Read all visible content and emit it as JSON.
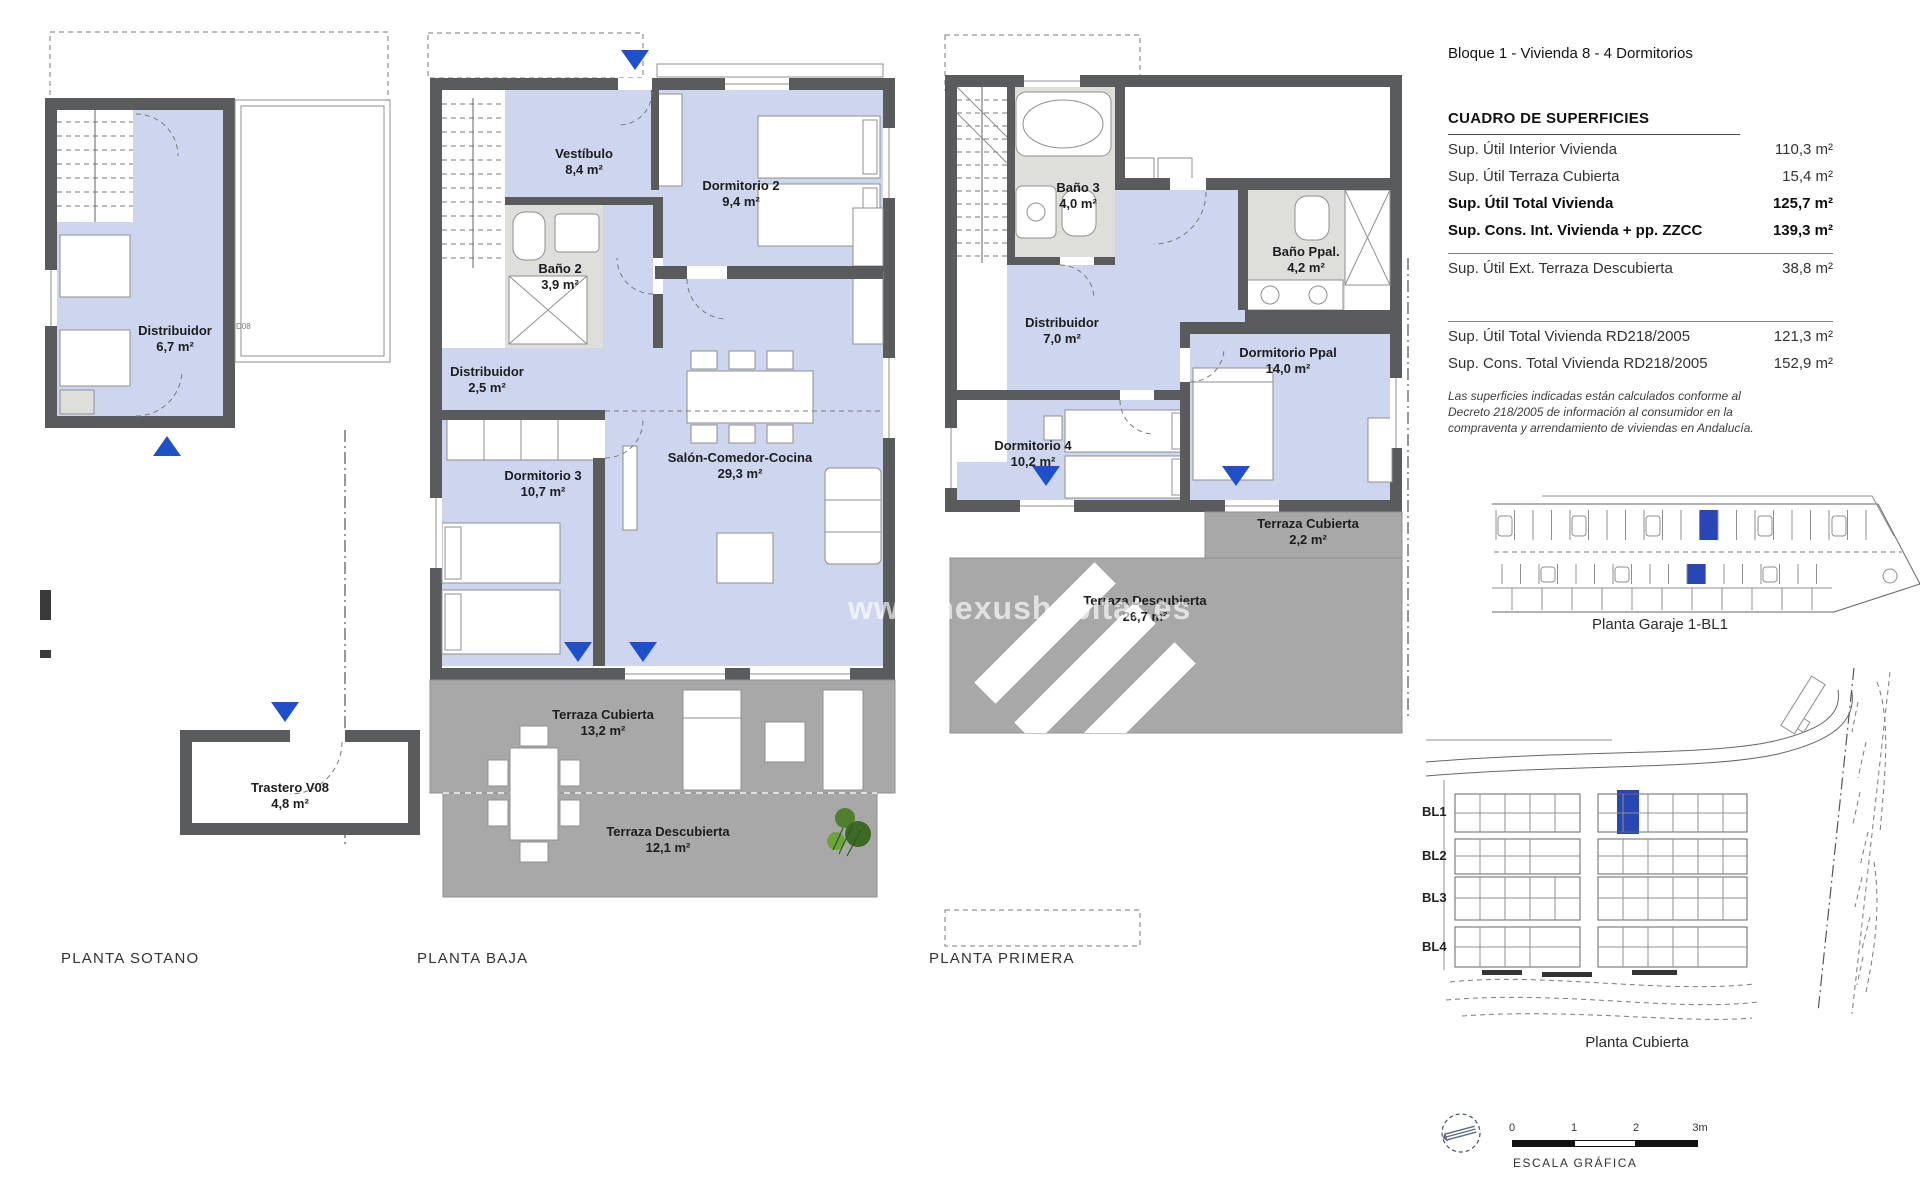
{
  "header": {
    "title": "Bloque 1 - Vivienda 8 - 4 Dormitorios"
  },
  "surface_table": {
    "title": "CUADRO DE SUPERFICIES",
    "group1": [
      {
        "label": "Sup. Útil Interior Vivienda",
        "value": "110,3 m²"
      },
      {
        "label": "Sup. Útil Terraza Cubierta",
        "value": "15,4 m²"
      },
      {
        "label": "Sup. Útil Total Vivienda",
        "value": "125,7 m²"
      },
      {
        "label": "Sup. Cons. Int. Vivienda + pp. ZZCC",
        "value": "139,3 m²"
      }
    ],
    "group2": [
      {
        "label": "Sup. Útil Ext. Terraza Descubierta",
        "value": "38,8 m²"
      }
    ],
    "group3": [
      {
        "label": "Sup. Útil Total Vivienda RD218/2005",
        "value": "121,3 m²"
      },
      {
        "label": "Sup. Cons. Total Vivienda RD218/2005",
        "value": "152,9 m²"
      }
    ],
    "note": "Las superficies indicadas están calculados conforme al Decreto 218/2005 de información al consumidor en la compraventa y arrendamiento de viviendas en Andalucía."
  },
  "plans": {
    "sotano": {
      "label": "PLANTA SOTANO",
      "tag": "D08",
      "rooms": [
        {
          "name": "Distribuidor",
          "area": "6,7 m²"
        },
        {
          "name": "Trastero V08",
          "area": "4,8 m²"
        }
      ]
    },
    "baja": {
      "label": "PLANTA BAJA",
      "rooms": [
        {
          "name": "Vestíbulo",
          "area": "8,4 m²"
        },
        {
          "name": "Dormitorio 2",
          "area": "9,4 m²"
        },
        {
          "name": "Baño 2",
          "area": "3,9 m²"
        },
        {
          "name": "Distribuidor",
          "area": "2,5 m²"
        },
        {
          "name": "Dormitorio 3",
          "area": "10,7 m²"
        },
        {
          "name": "Salón-Comedor-Cocina",
          "area": "29,3 m²"
        },
        {
          "name": "Terraza Cubierta",
          "area": "13,2 m²"
        },
        {
          "name": "Terraza Descubierta",
          "area": "12,1 m²"
        }
      ]
    },
    "primera": {
      "label": "PLANTA PRIMERA",
      "rooms": [
        {
          "name": "Baño 3",
          "area": "4,0 m²"
        },
        {
          "name": "Baño Ppal.",
          "area": "4,2 m²"
        },
        {
          "name": "Distribuidor",
          "area": "7,0 m²"
        },
        {
          "name": "Dormitorio Ppal",
          "area": "14,0 m²"
        },
        {
          "name": "Dormitorio 4",
          "area": "10,2 m²"
        },
        {
          "name": "Terraza Cubierta",
          "area": "2,2 m²"
        },
        {
          "name": "Terraza Descubierta",
          "area": "26,7 m²"
        }
      ]
    }
  },
  "side_panel": {
    "garage_caption": "Planta Garaje 1-BL1",
    "site_caption": "Planta Cubierta",
    "block_labels": [
      "BL1",
      "BL2",
      "BL3",
      "BL4"
    ],
    "scale_bar": {
      "ticks": [
        "0",
        "1",
        "2",
        "3m"
      ],
      "caption": "ESCALA GRÁFICA"
    }
  },
  "watermark": "www.nexushabitat.es",
  "colors": {
    "wall": "#5a5b5d",
    "room_fill": "#cdd6ee",
    "bath_fill": "#dedfdb",
    "terrace_fill": "#a8a8a8",
    "accent_blue": "#2050c8",
    "highlight_blue": "#2846b4",
    "watermark_white": "#ffffff"
  }
}
